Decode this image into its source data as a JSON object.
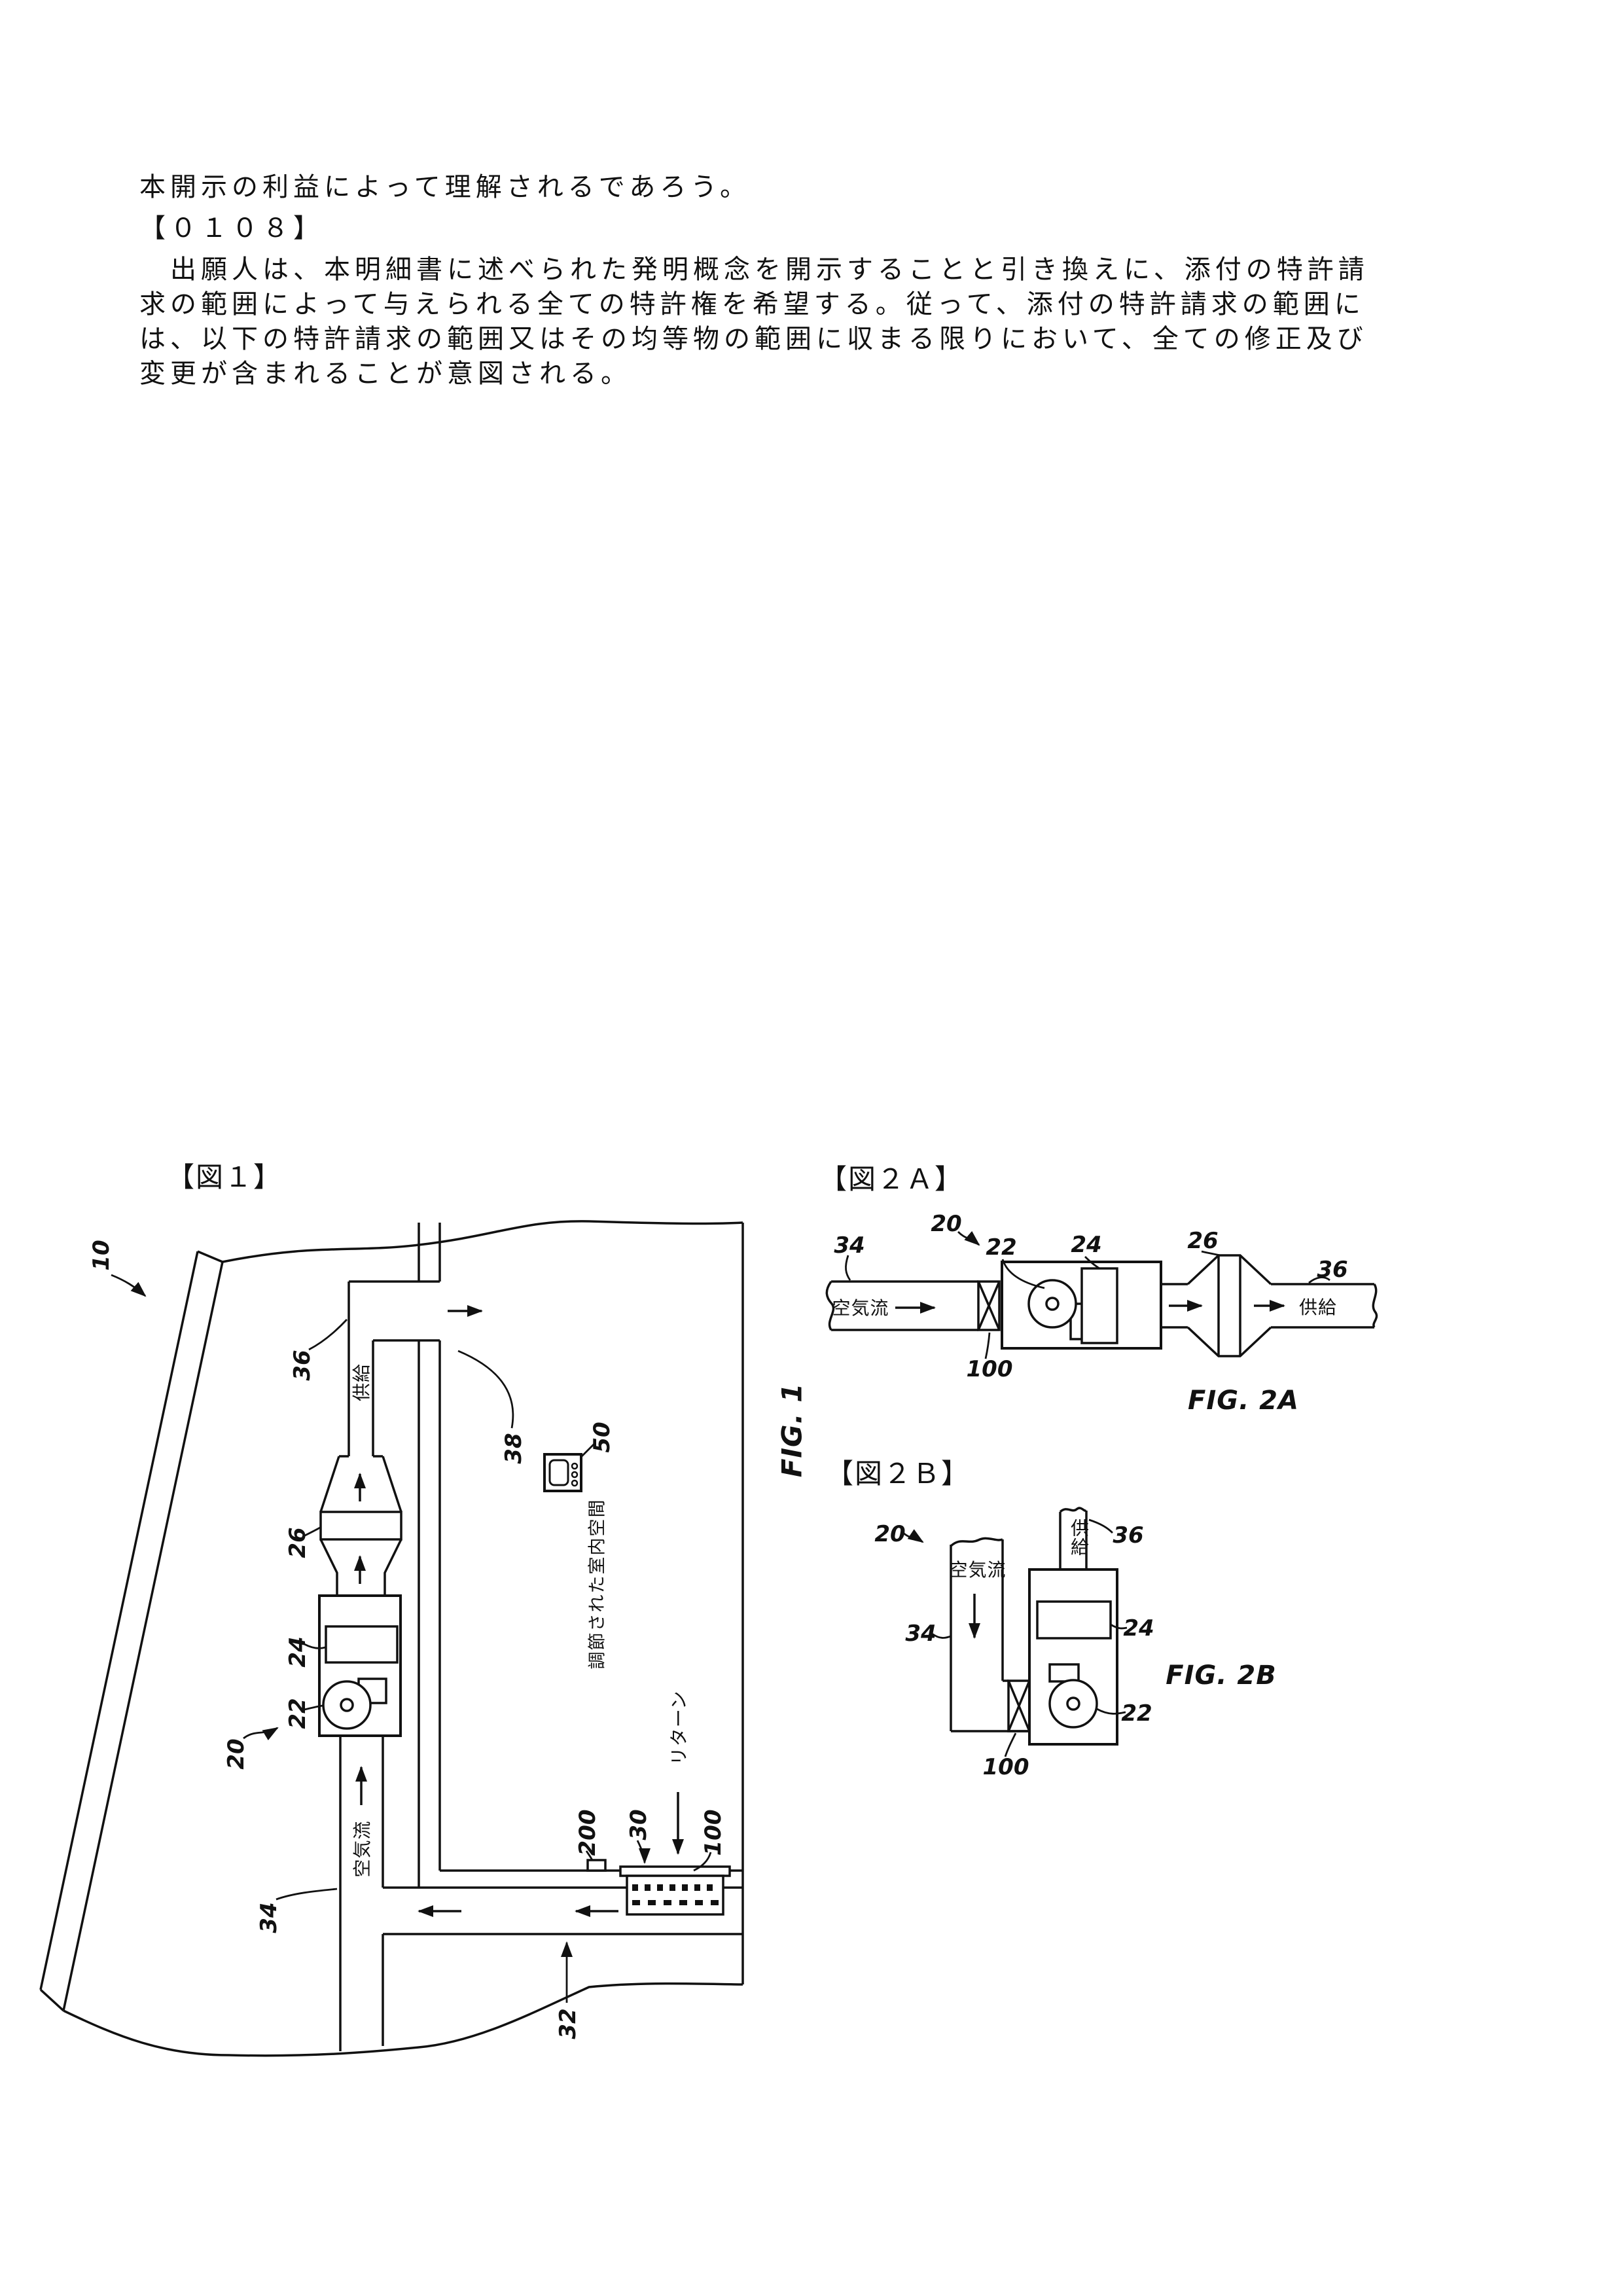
{
  "page": {
    "background": "#ffffff",
    "ink": "#111111"
  },
  "body_text": {
    "lines": [
      "本開示の利益によって理解されるであろう。",
      "【０１０８】",
      "　出願人は、本明細書に述べられた発明概念を開示することと引き換えに、添付の特許請",
      "求の範囲によって与えられる全ての特許権を希望する。従って、添付の特許請求の範囲に",
      "は、以下の特許請求の範囲又はその均等物の範囲に収まる限りにおいて、全ての修正及び",
      "変更が含まれることが意図される。"
    ]
  },
  "figures": {
    "fig1": {
      "tag": "【図１】",
      "caption": "FIG. 1",
      "refs": {
        "r10": "10",
        "r20": "20",
        "r22": "22",
        "r24": "24",
        "r26": "26",
        "r30": "30",
        "r32": "32",
        "r34": "34",
        "r36": "36",
        "r38": "38",
        "r50": "50",
        "r100": "100",
        "r200": "200"
      },
      "texts": {
        "supply": "供給",
        "airflow": "空気流",
        "return_flow": "リターン",
        "room": "調節された室内空間"
      }
    },
    "fig2a": {
      "tag": "【図２Ａ】",
      "caption": "FIG. 2A",
      "refs": {
        "r20": "20",
        "r22": "22",
        "r24": "24",
        "r26": "26",
        "r34": "34",
        "r36": "36",
        "r100": "100"
      },
      "texts": {
        "airflow": "空気流",
        "supply": "供給"
      }
    },
    "fig2b": {
      "tag": "【図２Ｂ】",
      "caption": "FIG. 2B",
      "refs": {
        "r20": "20",
        "r22": "22",
        "r24": "24",
        "r34": "34",
        "r36": "36",
        "r100": "100"
      },
      "texts": {
        "airflow": "空気流",
        "supply": "供給"
      }
    }
  }
}
